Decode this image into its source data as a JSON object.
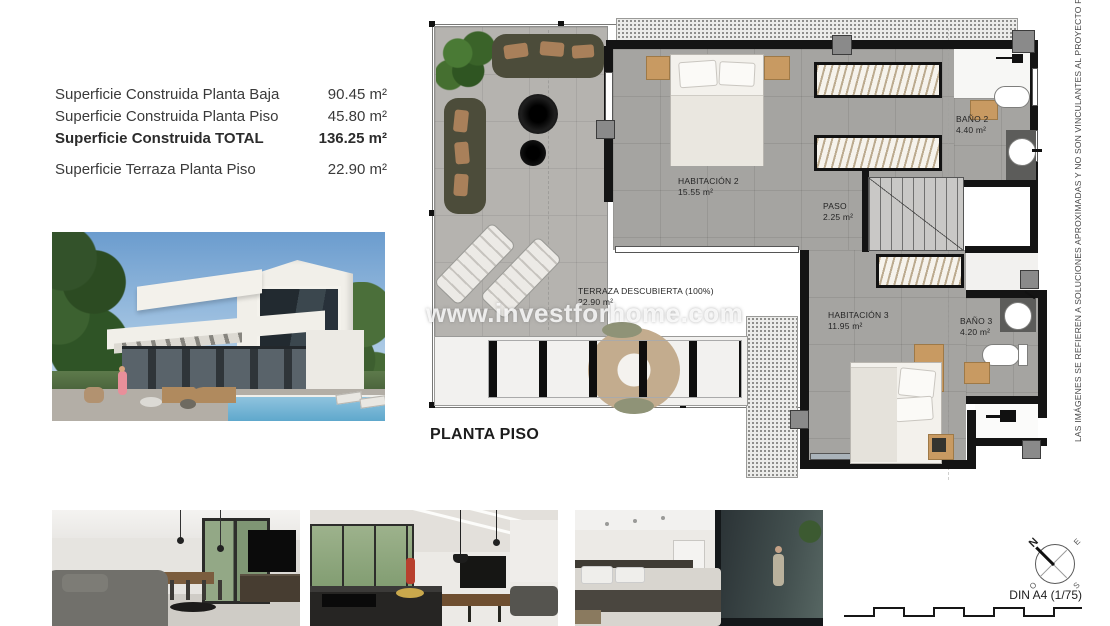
{
  "surface_table": {
    "rows": [
      {
        "label": "Superficie Construida Planta Baja",
        "value": "90.45 m²"
      },
      {
        "label": "Superficie Construida Planta Piso",
        "value": "45.80 m²"
      },
      {
        "label": "Superficie Construida TOTAL",
        "value": "136.25 m²"
      },
      {
        "label": "Superficie Terraza Planta Piso",
        "value": "22.90 m²"
      }
    ]
  },
  "plan": {
    "title": "PLANTA PISO",
    "watermark": "www.investforhome.com",
    "rooms": [
      {
        "name": "HABITACIÓN 2",
        "area": "15.55 m²"
      },
      {
        "name": "PASO",
        "area": "2.25 m²"
      },
      {
        "name": "BAÑO 2",
        "area": "4.40 m²"
      },
      {
        "name": "HABITACIÓN 3",
        "area": "11.95 m²"
      },
      {
        "name": "BAÑO 3",
        "area": "4.20 m²"
      },
      {
        "name": "TERRAZA DESCUBIERTA (100%)",
        "area": "22.90 m²"
      }
    ]
  },
  "disclaimer": "LAS IMÁGENES SE REFIEREN A SOLUCIONES APROXIMADAS Y NO SON VINCULANTES AL PROYECTO FINAL",
  "compass": {
    "n": "N",
    "e": "E",
    "s": "S",
    "o": "O"
  },
  "footer": {
    "scale_label": "DIN A4 (1/75)"
  },
  "colors": {
    "wall": "#141414",
    "floor": "#a5a4a1",
    "terrace_floor": "#b5b3af",
    "wood_accent": "#c89a62",
    "pool": "#7fb6d9"
  }
}
